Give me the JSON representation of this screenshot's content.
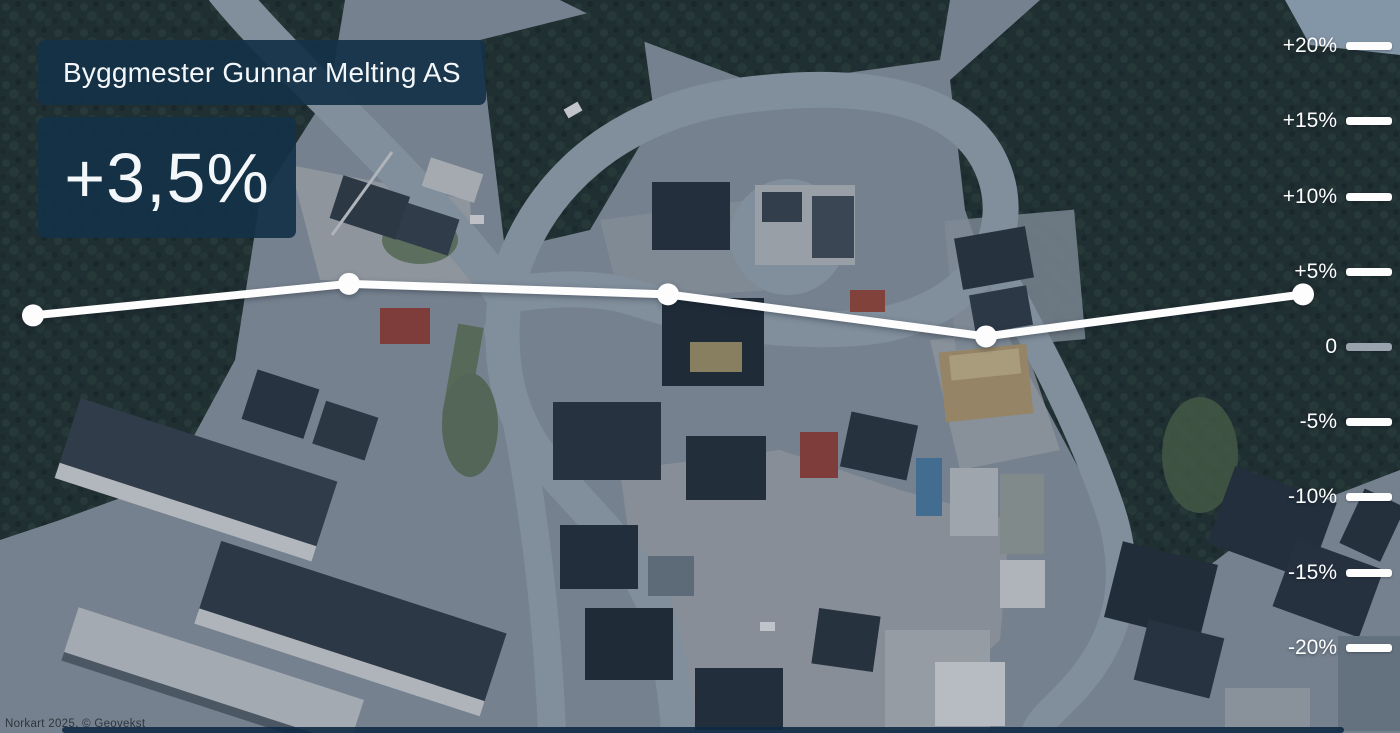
{
  "header": {
    "company_name": "Byggmester Gunnar Melting AS",
    "headline_value": "+3,5%"
  },
  "chart_data": {
    "type": "line",
    "values_percent": [
      2.1,
      4.2,
      3.5,
      0.7,
      3.5
    ],
    "end_value_label": "+3,5%",
    "y_axis": {
      "side": "right",
      "tick_labels": [
        "+20%",
        "+15%",
        "+10%",
        "+5%",
        "0",
        "-5%",
        "-10%",
        "-15%",
        "-20%"
      ],
      "ylim_percent": [
        -25.7,
        23.1
      ],
      "grid": false
    },
    "legend": "none",
    "line_color": "#fdfdfd",
    "marker": "circle",
    "pixel_geometry": {
      "zero_y_px": 347,
      "px_per_5pct": 75.2,
      "point_x_px": [
        33,
        349,
        668,
        986,
        1303
      ],
      "line_width_px": 8,
      "marker_radius_px": 11
    }
  },
  "map": {
    "attribution": "Norkart 2025, © Geovekst"
  },
  "colors": {
    "badge_background": "#14324a",
    "axis_tick": "#fdfdfd",
    "axis_zero_tick": "#99a3ad",
    "trend_line": "#fdfdfd",
    "footer_bar": "#102a44"
  }
}
